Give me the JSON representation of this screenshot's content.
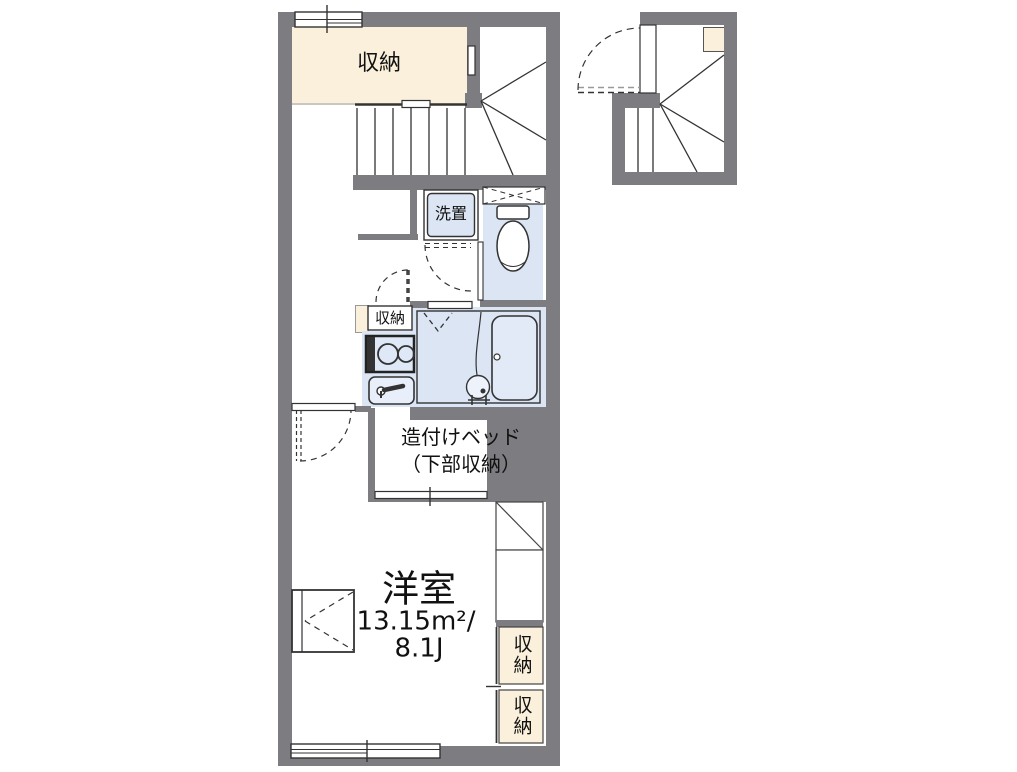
{
  "plan": {
    "title": "apartment-floor-plan",
    "closet_top": {
      "label": "収納"
    },
    "washer": {
      "label": "洗置"
    },
    "kitchen_storage": {
      "label": "収納"
    },
    "bed": {
      "line1": "造付けベッド",
      "line2": "（下部収納）"
    },
    "main_room": {
      "name": "洋室",
      "area_sqm": "13.15m²/",
      "area_tatami": "8.1J"
    },
    "storage_right_upper": {
      "label": "収納"
    },
    "storage_right_lower": {
      "label": "収納"
    }
  },
  "colors": {
    "wall": "#7d7d81",
    "storage_fill": "#fbf0db",
    "wet_area_fill": "#dbe5f4",
    "line": "#333333",
    "background": "#ffffff"
  }
}
